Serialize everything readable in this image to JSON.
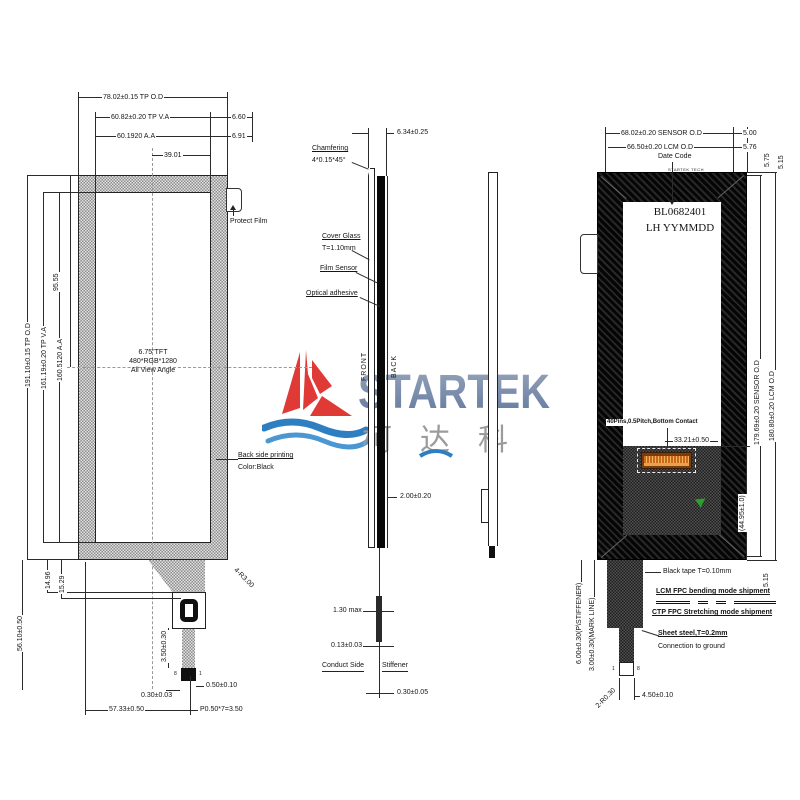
{
  "logo": {
    "name": "STARTEK",
    "cn": "柯达科"
  },
  "front_view": {
    "dim_width_tp_od": "78.02±0.15 TP O.D",
    "dim_width_tp_va": "60.82±0.20 TP V.A",
    "dim_margin_660": "6.60",
    "dim_width_aa": "60.1920 A.A",
    "dim_margin_691": "6.91",
    "dim_3901": "39.01",
    "dim_height_tp_od": "191.10±0.15 TP O.D",
    "dim_height_tp_va": "161.19±0.20 TP V.A",
    "dim_height_aa": "160.5120 A.A",
    "dim_9555": "95.55",
    "dim_5610": "56.10±0.50",
    "dim_1496": "14.96",
    "dim_1529": "15.29",
    "dim_corner_radius": "4-R3.00",
    "dim_350": "3.50±0.30",
    "dim_050": "0.50±0.10",
    "dim_030": "0.30±0.03",
    "dim_5733": "57.33±0.50",
    "dim_pitch": "P0.50*7=3.50",
    "pin_left": "8",
    "pin_right": "1",
    "display_line1": "6.75\"TFT",
    "display_line2": "480*RGB*1280",
    "display_line3": "All View Angle",
    "protect_film": "Protect Film",
    "back_print_line1": "Back side printing",
    "back_print_line2": "Color:Black"
  },
  "side_view": {
    "dim_thickness": "6.34±0.25",
    "chamfer_line1": "Chamfering",
    "chamfer_line2": "4*0.15*45°",
    "cover_glass_line1": "Cover Glass",
    "cover_glass_line2": "T=1.10mm",
    "film_sensor": "Film Sensor",
    "optical_adhesive": "Optical adhesive",
    "front_label": "FRONT",
    "back_label": "BACK",
    "dim_200": "2.00±0.20",
    "dim_130": "1.30 max",
    "dim_013": "0.13±0.03",
    "conduct_side": "Conduct Side",
    "stiffener": "Stiffener",
    "dim_0305": "0.30±0.05"
  },
  "back_view": {
    "dim_width_sensor": "68.02±0.20 SENSOR O.D",
    "dim_width_lcm": "66.50±0.20 LCM O.D",
    "dim_500": "5.00",
    "dim_576": "5.76",
    "dim_575": "5.75",
    "dim_515_top": "5.15",
    "date_code": "Date Code",
    "bezel_mark": "STARTEK TECH",
    "part_number": "BL0682401",
    "part_number2": "LH  YYMMDD",
    "pins_note": "40Pins,0.5Pitch,Bottom Contact",
    "dim_3321": "33.21±0.50",
    "dim_4495": "(44.95±1.0)",
    "dim_height_sensor": "179.69±0.20 SENSOR O.D",
    "dim_height_lcm": "180.80±0.20 LCM O.D",
    "black_tape": "Black tape T=0.10mm",
    "dim_515_bottom": "5.15",
    "ship_note1": "LCM FPC bending mode shipment",
    "ship_note2": "CTP FPC Stretching mode shipment",
    "sheet_steel_line1": "Sheet steel,T=0.2mm",
    "sheet_steel_line2": "Connection to ground",
    "dim_600": "6.00±0.30(P\\STIFFENER)",
    "dim_300": "3.00±0.30(MARK LINE)",
    "dim_r030": "2-R0.30",
    "dim_450": "4.50±0.10",
    "pin_left": "1",
    "pin_right": "8"
  },
  "colors": {
    "accent_red": "#e03a36",
    "wave_blue": "#2e7fc1",
    "connector_orange": "#d97b24",
    "ground_green": "#2ca02c"
  }
}
